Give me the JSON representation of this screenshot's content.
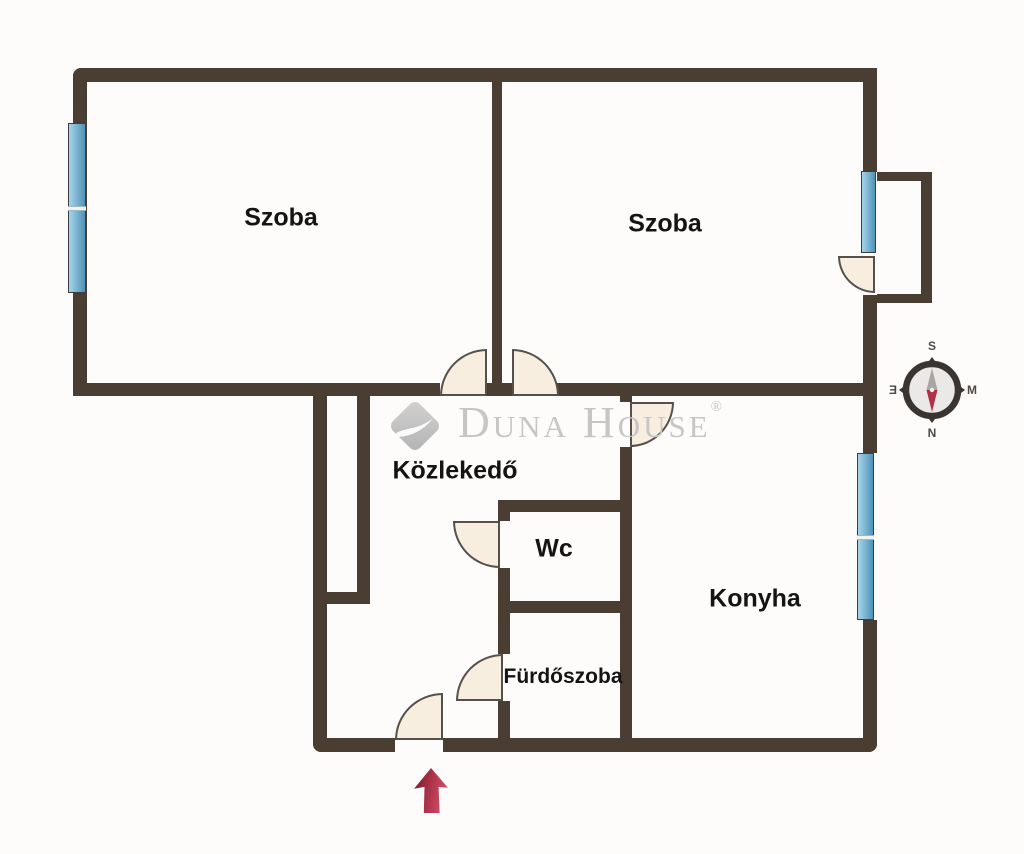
{
  "watermark": {
    "brand": "Duna House",
    "registered": "®"
  },
  "rooms": [
    {
      "id": "szoba-left",
      "label": "Szoba"
    },
    {
      "id": "szoba-right",
      "label": "Szoba"
    },
    {
      "id": "kozlekedo",
      "label": "Közlekedő"
    },
    {
      "id": "wc",
      "label": "Wc"
    },
    {
      "id": "furdoszoba",
      "label": "Fürdőszoba"
    },
    {
      "id": "konyha",
      "label": "Konyha"
    }
  ],
  "compass": {
    "top": "S",
    "right": "M",
    "bottom": "N",
    "left": "Ǝ"
  },
  "colors": {
    "wall": "#4a3e33",
    "door": "#f7eee0",
    "doorline": "#55504b",
    "winlight": "#a6d4ea",
    "windark": "#4e93b8",
    "arrow": "#c23b52",
    "logo": "#c6c6c6",
    "ink": "#141414",
    "bg": "#fdfcfb"
  }
}
